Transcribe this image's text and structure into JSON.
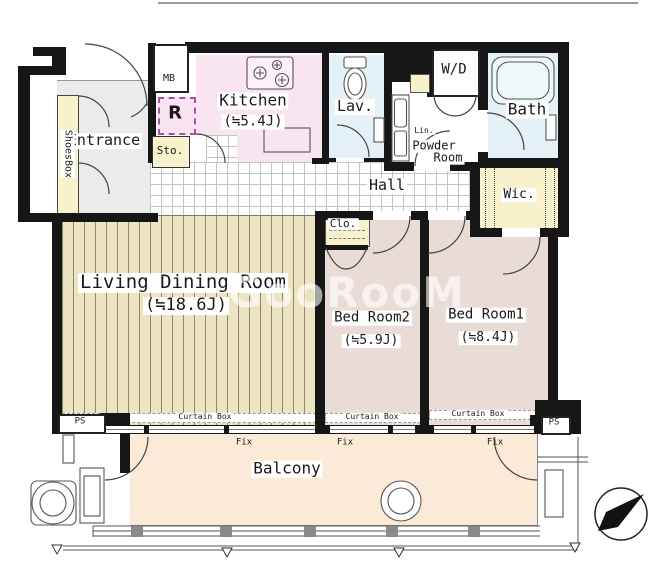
{
  "watermark": "GooRooM",
  "colors": {
    "wall": "#161616",
    "kitchen_floor": "#f9e4f2",
    "water_floor": "#e4f1f6",
    "closet_floor": "#f8f2cc",
    "entrance_floor": "#ebebeb",
    "wood_floor": "#ece4c0",
    "bedroom_floor": "#e9dcd6",
    "balcony_floor": "#fcead9"
  },
  "rooms": {
    "entrance": {
      "name": "Entrance"
    },
    "shoes_box": {
      "name": "ShoesBox"
    },
    "meter_box": {
      "name": "MB"
    },
    "refrigerator_space": {
      "name": "R"
    },
    "storage": {
      "name": "Sto."
    },
    "kitchen": {
      "name": "Kitchen",
      "area": "(≒5.4J)"
    },
    "lavatory": {
      "name": "Lav."
    },
    "washer_dryer": {
      "name": "W/D"
    },
    "linen": {
      "name": "Lin."
    },
    "powder_room": {
      "line1": "Powder",
      "line2": "Room"
    },
    "bath": {
      "name": "Bath"
    },
    "hall": {
      "name": "Hall"
    },
    "walk_in_closet": {
      "name": "Wic."
    },
    "closet": {
      "name": "Clo."
    },
    "living_dining_room": {
      "name": "Living Dining Room",
      "area": "(≒18.6J)"
    },
    "bedroom2": {
      "name": "Bed Room2",
      "area": "(≒5.9J)"
    },
    "bedroom1": {
      "name": "Bed Room1",
      "area": "(≒8.4J)"
    },
    "balcony": {
      "name": "Balcony"
    }
  },
  "annotations": {
    "curtain_box": "Curtain Box",
    "fix_window": "Fix",
    "pipe_space": "PS"
  }
}
